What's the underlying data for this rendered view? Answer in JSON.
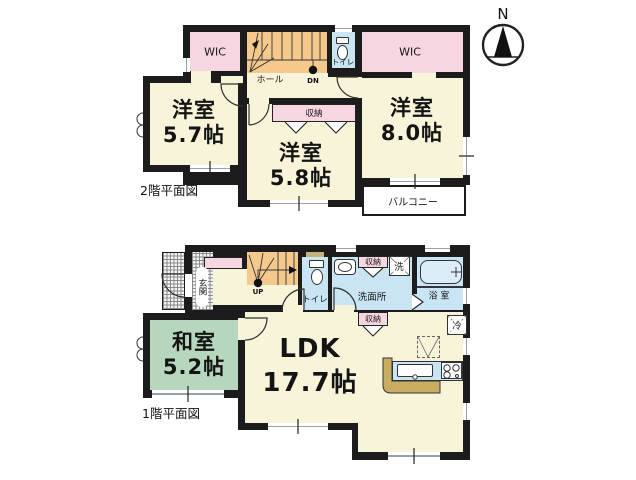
{
  "north": {
    "label": "N"
  },
  "floor2": {
    "caption": "2階平面図",
    "wic_left": "WIC",
    "wic_right": "WIC",
    "hall": "ホール",
    "down": "DN",
    "toilet": "トイレ",
    "closet": "収納",
    "balcony": "バルコニー",
    "room_nw": {
      "name": "洋室",
      "size": "5.7帖"
    },
    "room_s": {
      "name": "洋室",
      "size": "5.8帖"
    },
    "room_e": {
      "name": "洋室",
      "size": "8.0帖"
    }
  },
  "floor1": {
    "caption": "1階平面図",
    "entrance": "玄関",
    "up": "UP",
    "toilet": "トイレ",
    "washroom": "洗面所",
    "bath": "浴 室",
    "closet_washroom": "収納",
    "closet_ldk": "収納",
    "washer": "洗",
    "fridge": "冷",
    "washitsu": {
      "name": "和室",
      "size": "5.2帖"
    },
    "ldk": {
      "name": "LDK",
      "size": "17.7帖"
    }
  },
  "colors": {
    "wall": "#1c1c1c",
    "room_floor": "#F8F4D9",
    "closet_pink": "#F6D6E0",
    "stairs_orange": "#F5C98C",
    "water_blue": "#C9E4F3",
    "tatami_green": "#B6D6BE",
    "counter_tan": "#C8AD62"
  }
}
